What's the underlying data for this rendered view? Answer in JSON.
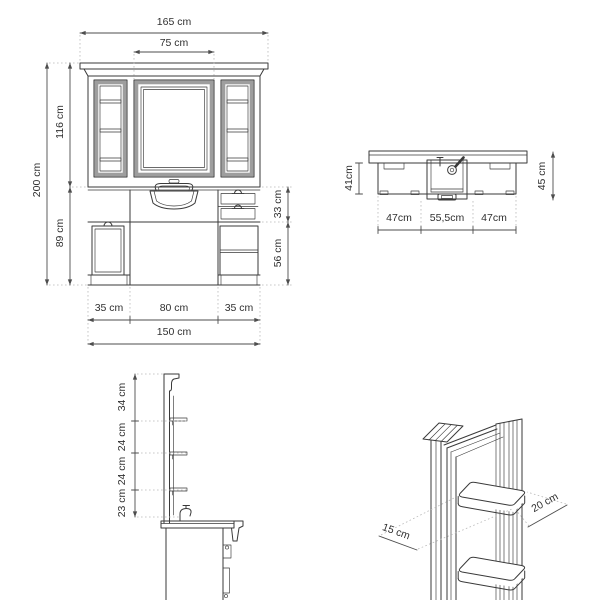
{
  "document": {
    "type": "furniture-technical-drawing",
    "unit": "cm"
  },
  "colors": {
    "background": "#ffffff",
    "line": "#3a3a3a",
    "frame_fill": "#9e9e9e",
    "dimension_line": "#4d4d4d",
    "extension_line": "#b9b9b9",
    "label_text": "#303030"
  },
  "views": {
    "front": {
      "name": "front-elevation",
      "dims": {
        "total_width": "165 cm",
        "mirror_width": "75 cm",
        "total_height": "200 cm",
        "upper_height": "116 cm",
        "lower_height": "89 cm",
        "drawer_section_height": "33 cm",
        "open_section_height": "56 cm",
        "bottom_left_width": "35 cm",
        "bottom_center_width": "80 cm",
        "bottom_right_width": "35 cm",
        "base_width": "150 cm"
      }
    },
    "plan": {
      "name": "counter-plan-view",
      "dims": {
        "left_depth": "41cm",
        "right_depth": "45 cm",
        "left_width": "47cm",
        "center_width": "55,5cm",
        "right_width": "47cm"
      }
    },
    "side": {
      "name": "side-section",
      "dims": {
        "top_section": "34 cm",
        "upper_gap": "24 cm",
        "lower_gap": "24 cm",
        "bottom_section": "23 cm"
      }
    },
    "perspective": {
      "name": "shelf-detail-perspective",
      "dims": {
        "shelf_depth": "15 cm",
        "shelf_width": "20 cm"
      }
    }
  }
}
